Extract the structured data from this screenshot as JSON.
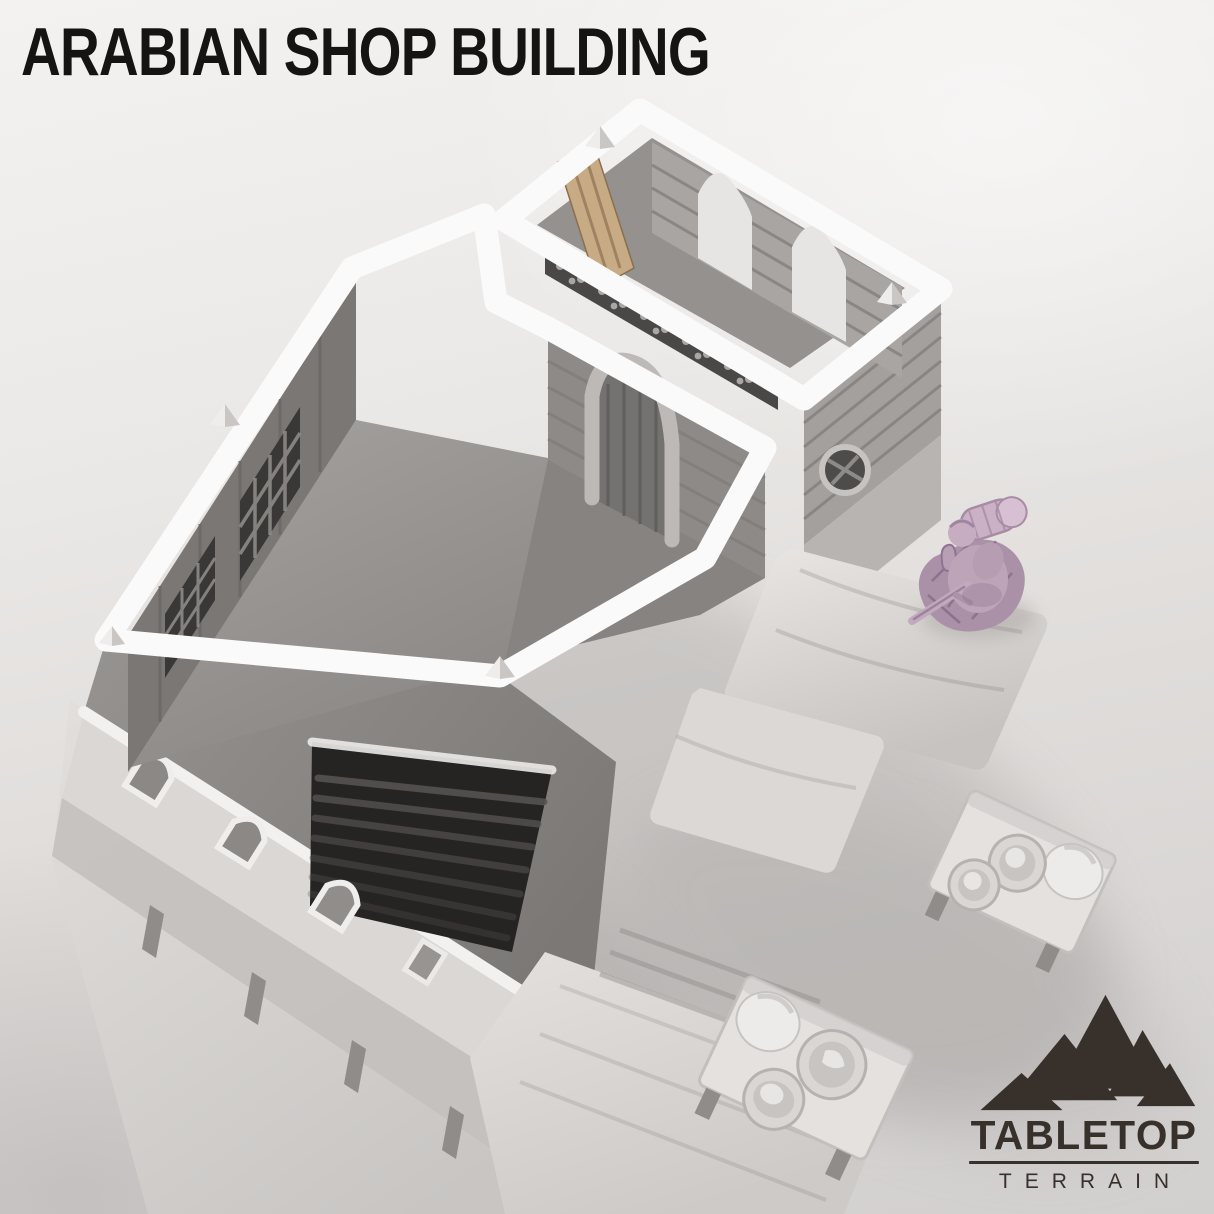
{
  "title": "ARABIAN SHOP BUILDING",
  "logo": {
    "primary": "TABLETOP",
    "secondary": "TERRAIN"
  },
  "colors": {
    "title-ink": "#151413",
    "brand-ink": "#38302b",
    "bg-top": "#f4f2f0",
    "bg-bottom": "#d2cfcf",
    "trim-white": "#fbfafa",
    "stone-mid": "#a3a09e",
    "stone-dark": "#787573",
    "floor-gray": "#979492",
    "figure-pink": "#bda4b9",
    "wood-tan": "#c7ab84"
  }
}
